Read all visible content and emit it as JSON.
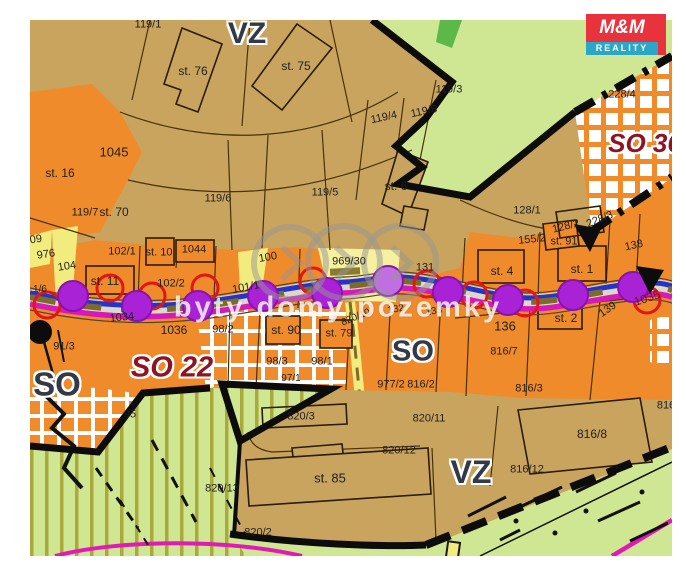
{
  "map": {
    "watermark": {
      "text": "byty domy pozemky"
    },
    "logo": {
      "line1": "M&M",
      "line2": "REALITY"
    },
    "colors": {
      "tan": "#c8a45f",
      "orange": "#ef8b2b",
      "light_green": "#cfe792",
      "bright_green": "#5db84a",
      "yellow": "#f2ec7e",
      "road_blue": "#2333cc",
      "magenta": "#d619b9",
      "purple_dot": "#aa22d6",
      "red_circle": "#e31616",
      "zone_red_text": "#8e1423",
      "zone_dark_text": "#323a47",
      "boundary_black": "#0c0c0c",
      "logo_red": "#e8323c",
      "logo_teal": "#2aa7c7"
    },
    "zone_labels": [
      {
        "t": "VZ",
        "x": 247,
        "y": 34,
        "cls": "z-dark",
        "fs": 30
      },
      {
        "t": "VZ",
        "x": 471,
        "y": 472,
        "cls": "z-dark",
        "fs": 32
      },
      {
        "t": "SO",
        "x": 57,
        "y": 384,
        "cls": "z-dark",
        "fs": 33
      },
      {
        "t": "SO",
        "x": 413,
        "y": 352,
        "cls": "z-dark",
        "fs": 29
      },
      {
        "t": "SO 22",
        "x": 172,
        "y": 368,
        "cls": "z-red",
        "fs": 29
      },
      {
        "t": "SO 36",
        "x": 645,
        "y": 143,
        "cls": "z-red",
        "fs": 26
      }
    ],
    "parcel_labels": [
      {
        "t": "119/1",
        "x": 148,
        "y": 25
      },
      {
        "t": "st. 76",
        "x": 193,
        "y": 71,
        "fs": 12
      },
      {
        "t": "st. 75",
        "x": 296,
        "y": 66,
        "fs": 12
      },
      {
        "t": "119/3",
        "x": 449,
        "y": 90
      },
      {
        "t": "119/4",
        "x": 384,
        "y": 118,
        "r": -12
      },
      {
        "t": "119/8",
        "x": 424,
        "y": 112,
        "r": -12
      },
      {
        "t": "228/4",
        "x": 622,
        "y": 95
      },
      {
        "t": "1045",
        "x": 114,
        "y": 152,
        "fs": 13
      },
      {
        "t": "st. 16",
        "x": 60,
        "y": 173,
        "fs": 12
      },
      {
        "t": "119/6",
        "x": 218,
        "y": 199
      },
      {
        "t": "119/5",
        "x": 325,
        "y": 193
      },
      {
        "t": "st. 6",
        "x": 396,
        "y": 186,
        "fs": 12
      },
      {
        "t": "128/1",
        "x": 527,
        "y": 211
      },
      {
        "t": "128/2",
        "x": 566,
        "y": 227,
        "r": -14
      },
      {
        "t": "228/3",
        "x": 600,
        "y": 220,
        "r": -22
      },
      {
        "t": "119/7",
        "x": 85,
        "y": 213
      },
      {
        "t": "st. 70",
        "x": 114,
        "y": 212,
        "fs": 12
      },
      {
        "t": "09",
        "x": 36,
        "y": 240,
        "r": -8
      },
      {
        "t": "976",
        "x": 46,
        "y": 255,
        "r": -8
      },
      {
        "t": "104",
        "x": 67,
        "y": 267,
        "r": -8
      },
      {
        "t": "102/1",
        "x": 122,
        "y": 252
      },
      {
        "t": "st. 10",
        "x": 159,
        "y": 253
      },
      {
        "t": "1044",
        "x": 194,
        "y": 250
      },
      {
        "t": "st. 11",
        "x": 105,
        "y": 281,
        "fs": 12
      },
      {
        "t": "102/2",
        "x": 171,
        "y": 284
      },
      {
        "t": "100",
        "x": 268,
        "y": 258,
        "r": -10
      },
      {
        "t": "969/30",
        "x": 349,
        "y": 262
      },
      {
        "t": "131",
        "x": 425,
        "y": 268
      },
      {
        "t": "101/1",
        "x": 246,
        "y": 288,
        "r": -10
      },
      {
        "t": "155/2",
        "x": 532,
        "y": 240,
        "r": -6
      },
      {
        "t": "st. 91",
        "x": 564,
        "y": 242
      },
      {
        "t": "138",
        "x": 634,
        "y": 246,
        "r": -12
      },
      {
        "t": "st. 4",
        "x": 502,
        "y": 271,
        "fs": 12
      },
      {
        "t": "st. 1",
        "x": 582,
        "y": 269,
        "fs": 12
      },
      {
        "t": "1034",
        "x": 122,
        "y": 318,
        "r": -6
      },
      {
        "t": "1036",
        "x": 174,
        "y": 330,
        "fs": 12
      },
      {
        "t": "98/2",
        "x": 223,
        "y": 330
      },
      {
        "t": "st. 90",
        "x": 286,
        "y": 330,
        "fs": 12
      },
      {
        "t": "st. 79",
        "x": 339,
        "y": 334
      },
      {
        "t": "820/10",
        "x": 356,
        "y": 318,
        "r": -22,
        "fs": 10
      },
      {
        "t": "132",
        "x": 396,
        "y": 310,
        "r": -10,
        "fs": 10
      },
      {
        "t": "133",
        "x": 434,
        "y": 312,
        "r": -10,
        "fs": 10
      },
      {
        "t": "91/3",
        "x": 64,
        "y": 347
      },
      {
        "t": "95",
        "x": 130,
        "y": 415
      },
      {
        "t": "98/3",
        "x": 277,
        "y": 362
      },
      {
        "t": "98/1",
        "x": 322,
        "y": 362
      },
      {
        "t": "97/1",
        "x": 291,
        "y": 379,
        "fs": 10
      },
      {
        "t": "977/2",
        "x": 391,
        "y": 385
      },
      {
        "t": "816/2",
        "x": 421,
        "y": 385
      },
      {
        "t": "816/3",
        "x": 529,
        "y": 389
      },
      {
        "t": "136",
        "x": 505,
        "y": 326,
        "fs": 13
      },
      {
        "t": "st. 2",
        "x": 566,
        "y": 318,
        "fs": 12
      },
      {
        "t": "139",
        "x": 608,
        "y": 310,
        "r": -35
      },
      {
        "t": "1035",
        "x": 647,
        "y": 298,
        "r": -18,
        "c": "#6b1616",
        "fs": 12
      },
      {
        "t": "816/7",
        "x": 504,
        "y": 352
      },
      {
        "t": "820/3",
        "x": 301,
        "y": 417
      },
      {
        "t": "820/11",
        "x": 429,
        "y": 419
      },
      {
        "t": "820/12",
        "x": 399,
        "y": 451
      },
      {
        "t": "820/13",
        "x": 222,
        "y": 489
      },
      {
        "t": "820/2",
        "x": 258,
        "y": 533
      },
      {
        "t": "st. 85",
        "x": 330,
        "y": 478,
        "fs": 13
      },
      {
        "t": "816/8",
        "x": 592,
        "y": 434,
        "fs": 12
      },
      {
        "t": "816/12",
        "x": 527,
        "y": 470
      },
      {
        "t": "816",
        "x": 666,
        "y": 406
      },
      {
        "t": "1/6",
        "x": 40,
        "y": 290,
        "fs": 10
      }
    ]
  }
}
